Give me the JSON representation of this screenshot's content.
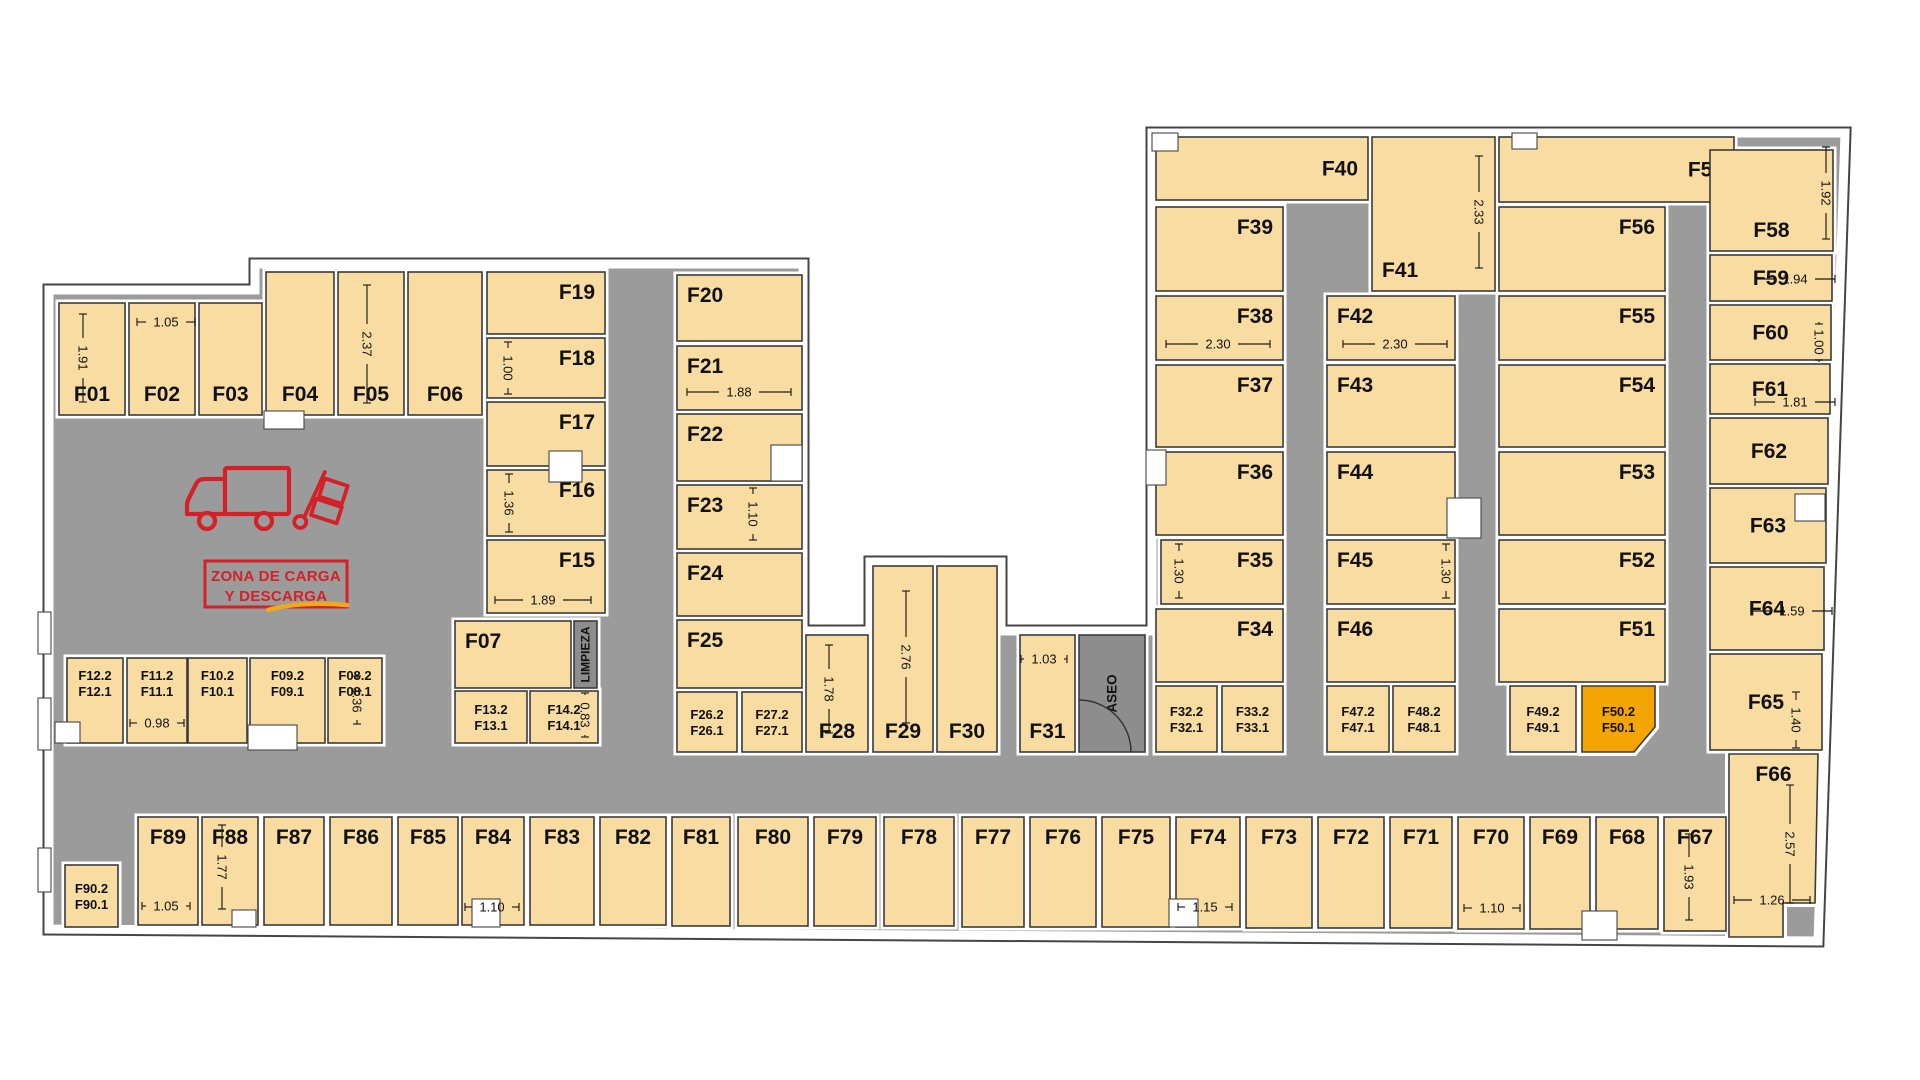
{
  "colors": {
    "room": "#F8DCA2",
    "corridor": "#9B9B9B",
    "service": "#8D8D8D",
    "highlight": "#F2A503",
    "wall_outline": "#454545",
    "room_stroke": "#3B3B3B",
    "accent_red": "#D42127",
    "accent_yellow": "#EFA91F",
    "text": "#111111"
  },
  "plan": {
    "zone": {
      "line1": "ZONA DE CARGA",
      "line2": "Y DESCARGA"
    },
    "service_rooms": [
      {
        "id": "limpieza",
        "label": "LIMPIEZA",
        "x": 574,
        "y": 621,
        "w": 23,
        "h": 67,
        "fs": 12
      },
      {
        "id": "aseo",
        "label": "ASEO",
        "x": 1079,
        "y": 635,
        "w": 66,
        "h": 117,
        "fs": 13.5
      }
    ],
    "rooms": [
      {
        "id": "F01",
        "label": "F01",
        "x": 59,
        "y": 303,
        "w": 66,
        "h": 112,
        "a": "bc"
      },
      {
        "id": "F02",
        "label": "F02",
        "x": 129,
        "y": 303,
        "w": 66,
        "h": 112,
        "a": "bc"
      },
      {
        "id": "F03",
        "label": "F03",
        "x": 199,
        "y": 303,
        "w": 63,
        "h": 112,
        "a": "bc"
      },
      {
        "id": "F04",
        "label": "F04",
        "x": 266,
        "y": 272,
        "w": 68,
        "h": 143,
        "a": "bc"
      },
      {
        "id": "F05",
        "label": "F05",
        "x": 338,
        "y": 272,
        "w": 66,
        "h": 143,
        "a": "bc"
      },
      {
        "id": "F06",
        "label": "F06",
        "x": 408,
        "y": 272,
        "w": 74,
        "h": 143,
        "a": "bc"
      },
      {
        "id": "F19",
        "label": "F19",
        "x": 487,
        "y": 272,
        "w": 118,
        "h": 62,
        "a": "tr"
      },
      {
        "id": "F18",
        "label": "F18",
        "x": 487,
        "y": 338,
        "w": 118,
        "h": 60,
        "a": "tr"
      },
      {
        "id": "F17",
        "label": "F17",
        "x": 487,
        "y": 402,
        "w": 118,
        "h": 64,
        "a": "tr"
      },
      {
        "id": "F16",
        "label": "F16",
        "x": 487,
        "y": 470,
        "w": 118,
        "h": 66,
        "a": "tr"
      },
      {
        "id": "F15",
        "label": "F15",
        "x": 487,
        "y": 540,
        "w": 118,
        "h": 73,
        "a": "tr"
      },
      {
        "id": "F07",
        "label": "F07",
        "x": 455,
        "y": 621,
        "w": 116,
        "h": 67,
        "a": "tl"
      },
      {
        "id": "F13",
        "label": "F13.2",
        "label2": "F13.1",
        "x": 455,
        "y": 691,
        "w": 72,
        "h": 52,
        "a": "c2"
      },
      {
        "id": "F14",
        "label": "F14.2",
        "label2": "F14.1",
        "x": 530,
        "y": 691,
        "w": 68,
        "h": 52,
        "a": "c2"
      },
      {
        "id": "F12",
        "label": "F12.2",
        "label2": "F12.1",
        "x": 67,
        "y": 658,
        "w": 56,
        "h": 85,
        "a": "t2"
      },
      {
        "id": "F11",
        "label": "F11.2",
        "label2": "F11.1",
        "x": 127,
        "y": 658,
        "w": 60,
        "h": 85,
        "a": "t2"
      },
      {
        "id": "F10",
        "label": "F10.2",
        "label2": "F10.1",
        "x": 188,
        "y": 658,
        "w": 59,
        "h": 85,
        "a": "t2"
      },
      {
        "id": "F09",
        "label": "F09.2",
        "label2": "F09.1",
        "x": 250,
        "y": 658,
        "w": 75,
        "h": 85,
        "a": "t2"
      },
      {
        "id": "F08",
        "label": "F08.2",
        "label2": "F08.1",
        "x": 328,
        "y": 658,
        "w": 54,
        "h": 85,
        "a": "t2"
      },
      {
        "id": "F20",
        "label": "F20",
        "x": 677,
        "y": 275,
        "w": 125,
        "h": 66,
        "a": "tl"
      },
      {
        "id": "F21",
        "label": "F21",
        "x": 677,
        "y": 346,
        "w": 125,
        "h": 64,
        "a": "tl"
      },
      {
        "id": "F22",
        "label": "F22",
        "x": 677,
        "y": 414,
        "w": 125,
        "h": 67,
        "a": "tl"
      },
      {
        "id": "F23",
        "label": "F23",
        "x": 677,
        "y": 485,
        "w": 125,
        "h": 64,
        "a": "tl"
      },
      {
        "id": "F24",
        "label": "F24",
        "x": 677,
        "y": 553,
        "w": 125,
        "h": 63,
        "a": "tl"
      },
      {
        "id": "F25",
        "label": "F25",
        "x": 677,
        "y": 620,
        "w": 125,
        "h": 68,
        "a": "tl"
      },
      {
        "id": "F26",
        "label": "F26.2",
        "label2": "F26.1",
        "x": 677,
        "y": 692,
        "w": 60,
        "h": 60,
        "a": "c2"
      },
      {
        "id": "F27",
        "label": "F27.2",
        "label2": "F27.1",
        "x": 742,
        "y": 692,
        "w": 60,
        "h": 60,
        "a": "c2"
      },
      {
        "id": "F28",
        "label": "F28",
        "x": 806,
        "y": 635,
        "w": 62,
        "h": 117,
        "a": "bc"
      },
      {
        "id": "F29",
        "label": "F29",
        "x": 873,
        "y": 566,
        "w": 60,
        "h": 186,
        "a": "bc"
      },
      {
        "id": "F30",
        "label": "F30",
        "x": 937,
        "y": 566,
        "w": 60,
        "h": 186,
        "a": "bc"
      },
      {
        "id": "F31",
        "label": "F31",
        "x": 1020,
        "y": 635,
        "w": 55,
        "h": 117,
        "a": "bc"
      },
      {
        "id": "F40",
        "label": "F40",
        "x": 1156,
        "y": 137,
        "w": 212,
        "h": 63,
        "a": "mr"
      },
      {
        "id": "F39",
        "label": "F39",
        "x": 1156,
        "y": 207,
        "w": 127,
        "h": 84,
        "a": "tr"
      },
      {
        "id": "F38",
        "label": "F38",
        "x": 1156,
        "y": 296,
        "w": 127,
        "h": 64,
        "a": "tr"
      },
      {
        "id": "F37",
        "label": "F37",
        "x": 1156,
        "y": 365,
        "w": 127,
        "h": 82,
        "a": "tr"
      },
      {
        "id": "F36",
        "label": "F36",
        "x": 1156,
        "y": 452,
        "w": 127,
        "h": 83,
        "a": "tr"
      },
      {
        "id": "F35",
        "label": "F35",
        "x": 1161,
        "y": 540,
        "w": 122,
        "h": 64,
        "a": "tr"
      },
      {
        "id": "F34",
        "label": "F34",
        "x": 1156,
        "y": 609,
        "w": 127,
        "h": 73,
        "a": "tr"
      },
      {
        "id": "F32",
        "label": "F32.2",
        "label2": "F32.1",
        "x": 1156,
        "y": 686,
        "w": 61,
        "h": 66,
        "a": "c2"
      },
      {
        "id": "F33",
        "label": "F33.2",
        "label2": "F33.1",
        "x": 1222,
        "y": 686,
        "w": 61,
        "h": 66,
        "a": "c2"
      },
      {
        "id": "F41",
        "label": "F41",
        "x": 1372,
        "y": 137,
        "w": 123,
        "h": 154,
        "a": "bl"
      },
      {
        "id": "F42",
        "label": "F42",
        "x": 1327,
        "y": 296,
        "w": 128,
        "h": 64,
        "a": "tl"
      },
      {
        "id": "F43",
        "label": "F43",
        "x": 1327,
        "y": 365,
        "w": 128,
        "h": 82,
        "a": "tl"
      },
      {
        "id": "F44",
        "label": "F44",
        "x": 1327,
        "y": 452,
        "w": 128,
        "h": 83,
        "a": "tl"
      },
      {
        "id": "F45",
        "label": "F45",
        "x": 1327,
        "y": 540,
        "w": 128,
        "h": 64,
        "a": "tl"
      },
      {
        "id": "F46",
        "label": "F46",
        "x": 1327,
        "y": 609,
        "w": 128,
        "h": 73,
        "a": "tl"
      },
      {
        "id": "F47",
        "label": "F47.2",
        "label2": "F47.1",
        "x": 1327,
        "y": 686,
        "w": 62,
        "h": 66,
        "a": "c2"
      },
      {
        "id": "F48",
        "label": "F48.2",
        "label2": "F48.1",
        "x": 1393,
        "y": 686,
        "w": 62,
        "h": 66,
        "a": "c2"
      },
      {
        "id": "F57",
        "label": "F57",
        "x": 1499,
        "y": 137,
        "w": 235,
        "h": 65,
        "a": "mr"
      },
      {
        "id": "F56",
        "label": "F56",
        "x": 1499,
        "y": 207,
        "w": 166,
        "h": 84,
        "a": "tr"
      },
      {
        "id": "F55",
        "label": "F55",
        "x": 1499,
        "y": 296,
        "w": 166,
        "h": 64,
        "a": "tr"
      },
      {
        "id": "F54",
        "label": "F54",
        "x": 1499,
        "y": 365,
        "w": 166,
        "h": 82,
        "a": "tr"
      },
      {
        "id": "F53",
        "label": "F53",
        "x": 1499,
        "y": 452,
        "w": 166,
        "h": 83,
        "a": "tr"
      },
      {
        "id": "F52",
        "label": "F52",
        "x": 1499,
        "y": 540,
        "w": 166,
        "h": 64,
        "a": "tr"
      },
      {
        "id": "F51",
        "label": "F51",
        "x": 1499,
        "y": 609,
        "w": 166,
        "h": 73,
        "a": "tr"
      },
      {
        "id": "F49",
        "label": "F49.2",
        "label2": "F49.1",
        "x": 1510,
        "y": 686,
        "w": 66,
        "h": 66,
        "a": "c2"
      },
      {
        "id": "F50",
        "label": "F50.2",
        "label2": "F50.1",
        "x": 1582,
        "y": 686,
        "w": 73,
        "h": 66,
        "a": "c2",
        "hl": true,
        "poly": "1582,686 1655,686 1655,727 1634,752 1582,752"
      },
      {
        "id": "F58",
        "label": "F58",
        "x": 1710,
        "y": 150,
        "w": 123,
        "h": 101,
        "a": "bc"
      },
      {
        "id": "F59",
        "label": "F59",
        "x": 1710,
        "y": 255,
        "w": 122,
        "h": 46,
        "a": "mc"
      },
      {
        "id": "F60",
        "label": "F60",
        "x": 1710,
        "y": 305,
        "w": 121,
        "h": 55,
        "a": "mc"
      },
      {
        "id": "F61",
        "label": "F61",
        "x": 1710,
        "y": 364,
        "w": 120,
        "h": 50,
        "a": "mc"
      },
      {
        "id": "F62",
        "label": "F62",
        "x": 1710,
        "y": 418,
        "w": 118,
        "h": 66,
        "a": "mc"
      },
      {
        "id": "F63",
        "label": "F63",
        "x": 1710,
        "y": 488,
        "w": 116,
        "h": 75,
        "a": "mc"
      },
      {
        "id": "F64",
        "label": "F64",
        "x": 1710,
        "y": 567,
        "w": 114,
        "h": 83,
        "a": "mc"
      },
      {
        "id": "F65",
        "label": "F65",
        "x": 1710,
        "y": 654,
        "w": 112,
        "h": 96,
        "a": "mc"
      },
      {
        "id": "F66",
        "label": "F66",
        "x": 1729,
        "y": 754,
        "w": 89,
        "h": 150,
        "a": "tc",
        "poly": "1729,754 1818,754 1815,903 1783,903 1783,937 1729,937"
      },
      {
        "id": "F67",
        "label": "F67",
        "x": 1664,
        "y": 817,
        "w": 62,
        "h": 114,
        "a": "tc"
      },
      {
        "id": "F68",
        "label": "F68",
        "x": 1596,
        "y": 817,
        "w": 62,
        "h": 112,
        "a": "tc"
      },
      {
        "id": "F69",
        "label": "F69",
        "x": 1530,
        "y": 817,
        "w": 60,
        "h": 112,
        "a": "tc"
      },
      {
        "id": "F70",
        "label": "F70",
        "x": 1458,
        "y": 817,
        "w": 66,
        "h": 112,
        "a": "tc"
      },
      {
        "id": "F71",
        "label": "F71",
        "x": 1390,
        "y": 817,
        "w": 62,
        "h": 111,
        "a": "tc"
      },
      {
        "id": "F72",
        "label": "F72",
        "x": 1318,
        "y": 817,
        "w": 66,
        "h": 111,
        "a": "tc"
      },
      {
        "id": "F73",
        "label": "F73",
        "x": 1246,
        "y": 817,
        "w": 66,
        "h": 111,
        "a": "tc"
      },
      {
        "id": "F74",
        "label": "F74",
        "x": 1176,
        "y": 817,
        "w": 64,
        "h": 110,
        "a": "tc"
      },
      {
        "id": "F75",
        "label": "F75",
        "x": 1102,
        "y": 817,
        "w": 68,
        "h": 110,
        "a": "tc"
      },
      {
        "id": "F76",
        "label": "F76",
        "x": 1030,
        "y": 817,
        "w": 66,
        "h": 110,
        "a": "tc"
      },
      {
        "id": "F77",
        "label": "F77",
        "x": 962,
        "y": 817,
        "w": 62,
        "h": 110,
        "a": "tc"
      },
      {
        "id": "F78",
        "label": "F78",
        "x": 884,
        "y": 817,
        "w": 70,
        "h": 109,
        "a": "tc"
      },
      {
        "id": "F79",
        "label": "F79",
        "x": 814,
        "y": 817,
        "w": 62,
        "h": 109,
        "a": "tc"
      },
      {
        "id": "F80",
        "label": "F80",
        "x": 738,
        "y": 817,
        "w": 70,
        "h": 109,
        "a": "tc"
      },
      {
        "id": "F81",
        "label": "F81",
        "x": 672,
        "y": 817,
        "w": 58,
        "h": 109,
        "a": "tc"
      },
      {
        "id": "F82",
        "label": "F82",
        "x": 600,
        "y": 817,
        "w": 66,
        "h": 108,
        "a": "tc"
      },
      {
        "id": "F83",
        "label": "F83",
        "x": 530,
        "y": 817,
        "w": 64,
        "h": 108,
        "a": "tc"
      },
      {
        "id": "F84",
        "label": "F84",
        "x": 462,
        "y": 817,
        "w": 62,
        "h": 108,
        "a": "tc"
      },
      {
        "id": "F85",
        "label": "F85",
        "x": 398,
        "y": 817,
        "w": 60,
        "h": 108,
        "a": "tc"
      },
      {
        "id": "F86",
        "label": "F86",
        "x": 330,
        "y": 817,
        "w": 62,
        "h": 108,
        "a": "tc"
      },
      {
        "id": "F87",
        "label": "F87",
        "x": 264,
        "y": 817,
        "w": 60,
        "h": 108,
        "a": "tc"
      },
      {
        "id": "F88",
        "label": "F88",
        "x": 202,
        "y": 817,
        "w": 56,
        "h": 108,
        "a": "tc"
      },
      {
        "id": "F89",
        "label": "F89",
        "x": 138,
        "y": 817,
        "w": 60,
        "h": 108,
        "a": "tc"
      },
      {
        "id": "F90",
        "label": "F90.2",
        "label2": "F90.1",
        "x": 65,
        "y": 865,
        "w": 53,
        "h": 62,
        "a": "c2"
      }
    ],
    "dims": [
      {
        "text": "1.91",
        "x": 83,
        "y": 358,
        "len": 88,
        "v": true
      },
      {
        "text": "1.05",
        "x": 166,
        "y": 322,
        "len": 58
      },
      {
        "text": "2.37",
        "x": 367,
        "y": 344,
        "len": 118,
        "v": true
      },
      {
        "text": "1.00",
        "x": 508,
        "y": 368,
        "len": 52,
        "v": true
      },
      {
        "text": "1.36",
        "x": 509,
        "y": 503,
        "len": 58,
        "v": true
      },
      {
        "text": "1.89",
        "x": 543,
        "y": 600,
        "len": 96
      },
      {
        "text": "1.88",
        "x": 739,
        "y": 392,
        "len": 104
      },
      {
        "text": "1.10",
        "x": 753,
        "y": 514,
        "len": 52,
        "v": true
      },
      {
        "text": "0.83",
        "x": 585,
        "y": 715,
        "len": 44,
        "v": true
      },
      {
        "text": "0.98",
        "x": 157,
        "y": 723,
        "len": 54
      },
      {
        "text": "1.36",
        "x": 357,
        "y": 700,
        "len": 48,
        "v": true
      },
      {
        "text": "1.78",
        "x": 829,
        "y": 689,
        "len": 88,
        "v": true
      },
      {
        "text": "2.76",
        "x": 906,
        "y": 657,
        "len": 132,
        "v": true
      },
      {
        "text": "1.03",
        "x": 1044,
        "y": 659,
        "len": 46
      },
      {
        "text": "1.30",
        "x": 1179,
        "y": 571,
        "len": 54,
        "v": true
      },
      {
        "text": "1.30",
        "x": 1446,
        "y": 571,
        "len": 54,
        "v": true
      },
      {
        "text": "2.30",
        "x": 1218,
        "y": 344,
        "len": 104
      },
      {
        "text": "2.30",
        "x": 1395,
        "y": 344,
        "len": 104
      },
      {
        "text": "2.33",
        "x": 1479,
        "y": 212,
        "len": 112,
        "v": true
      },
      {
        "text": "1.92",
        "x": 1826,
        "y": 193,
        "len": 92,
        "v": true
      },
      {
        "text": "1.94",
        "x": 1795,
        "y": 279,
        "len": 80
      },
      {
        "text": "1.00",
        "x": 1819,
        "y": 342,
        "len": 36,
        "v": true
      },
      {
        "text": "1.81",
        "x": 1795,
        "y": 402,
        "len": 80
      },
      {
        "text": "1.59",
        "x": 1792,
        "y": 611,
        "len": 80
      },
      {
        "text": "1.40",
        "x": 1796,
        "y": 720,
        "len": 56,
        "v": true
      },
      {
        "text": "2.57",
        "x": 1790,
        "y": 844,
        "len": 118,
        "v": true
      },
      {
        "text": "1.26",
        "x": 1772,
        "y": 900,
        "len": 76
      },
      {
        "text": "1.05",
        "x": 166,
        "y": 906,
        "len": 48
      },
      {
        "text": "1.77",
        "x": 222,
        "y": 867,
        "len": 84,
        "v": true
      },
      {
        "text": "1.10",
        "x": 492,
        "y": 907,
        "len": 54
      },
      {
        "text": "1.15",
        "x": 1205,
        "y": 907,
        "len": 54
      },
      {
        "text": "1.10",
        "x": 1492,
        "y": 908,
        "len": 56
      },
      {
        "text": "1.93",
        "x": 1689,
        "y": 877,
        "len": 86,
        "v": true
      }
    ]
  }
}
